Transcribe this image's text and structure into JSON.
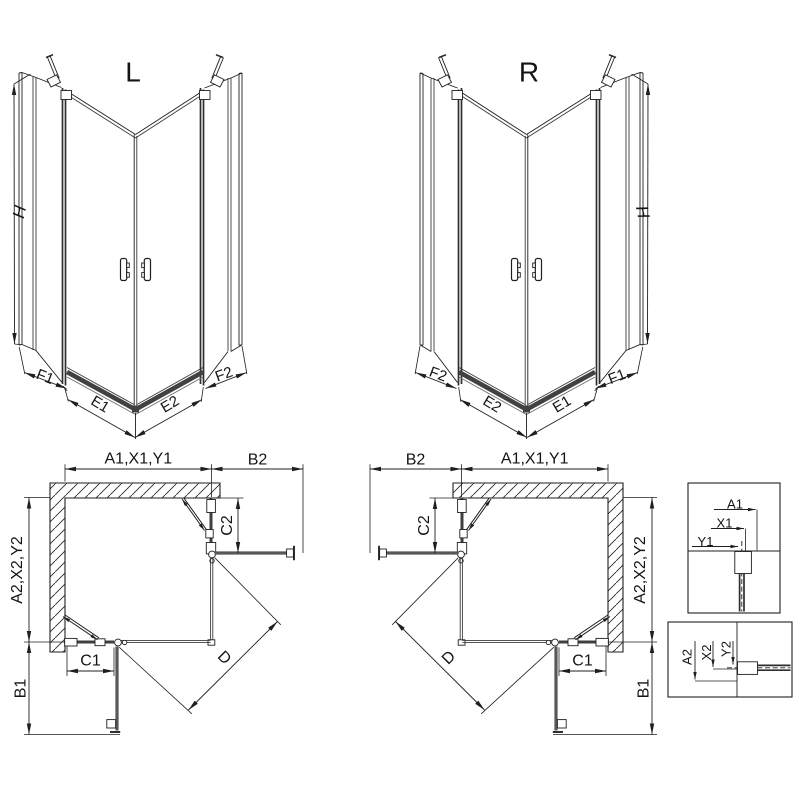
{
  "page": {
    "background": "#ffffff"
  },
  "palette": {
    "line": "#1f1f1f",
    "glass": "#3c3c3c",
    "profile": "#2e2e2e",
    "panel": "#3f3f3f",
    "door_open": "#575757",
    "sill": "#414141",
    "text": "#141414"
  },
  "views": {
    "iso_left": {
      "title": "L",
      "height_label": "H",
      "segment_labels": [
        "F1",
        "E1",
        "E2",
        "F2"
      ]
    },
    "iso_right": {
      "title": "R",
      "height_label": "H",
      "segment_labels": [
        "F2",
        "E2",
        "E1",
        "F1"
      ]
    },
    "plan_left": {
      "top_width": "A1,X1,Y1",
      "top_extension": "B2",
      "hinge_panel": "C2",
      "side_depth": "A2,X2,Y2",
      "fixed_panel": "C1",
      "door_swing": "B1",
      "diagonal_entry": "D"
    },
    "plan_right": {
      "top_width": "A1,X1,Y1",
      "top_extension": "B2",
      "hinge_panel": "C2",
      "side_depth": "A2,X2,Y2",
      "fixed_panel": "C1",
      "door_swing": "B1",
      "diagonal_entry": "D"
    },
    "detail_top": {
      "dims": [
        "A1",
        "X1",
        "Y1"
      ]
    },
    "detail_bottom": {
      "dims": [
        "A2",
        "X2",
        "Y2"
      ]
    }
  }
}
